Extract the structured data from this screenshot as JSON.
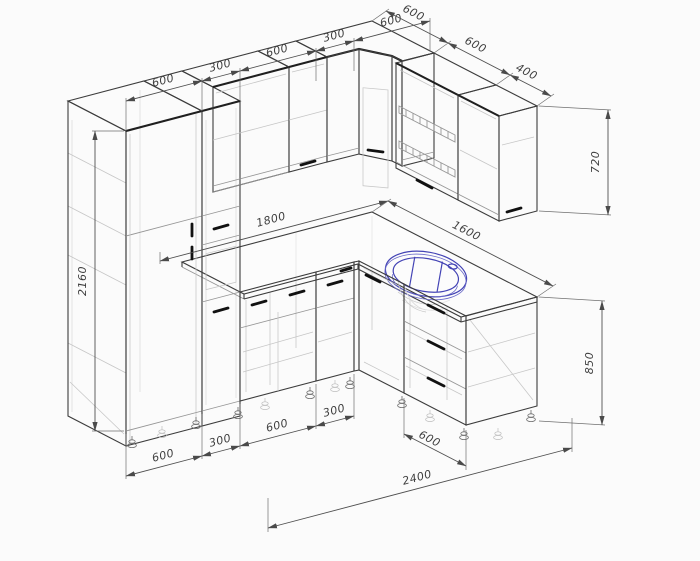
{
  "drawing": {
    "title": "L-shaped kitchen set technical drawing",
    "style": "isometric CAD wireframe",
    "line_color": "#3c3c3c",
    "sink_color": "#4343b5",
    "background": "#fbfbfb"
  },
  "dims": {
    "top_left_chain": [
      "600",
      "300",
      "600",
      "300",
      "600"
    ],
    "right_chain": [
      "600",
      "600",
      "400"
    ],
    "wall_cabinet_height": "720",
    "tall_unit_height": "2160",
    "counter_left": "1800",
    "counter_right": "1600",
    "base_height": "850",
    "bottom_chain": [
      "600",
      "300",
      "600",
      "300"
    ],
    "total_width": "2400",
    "right_base_unit_width": "600"
  }
}
